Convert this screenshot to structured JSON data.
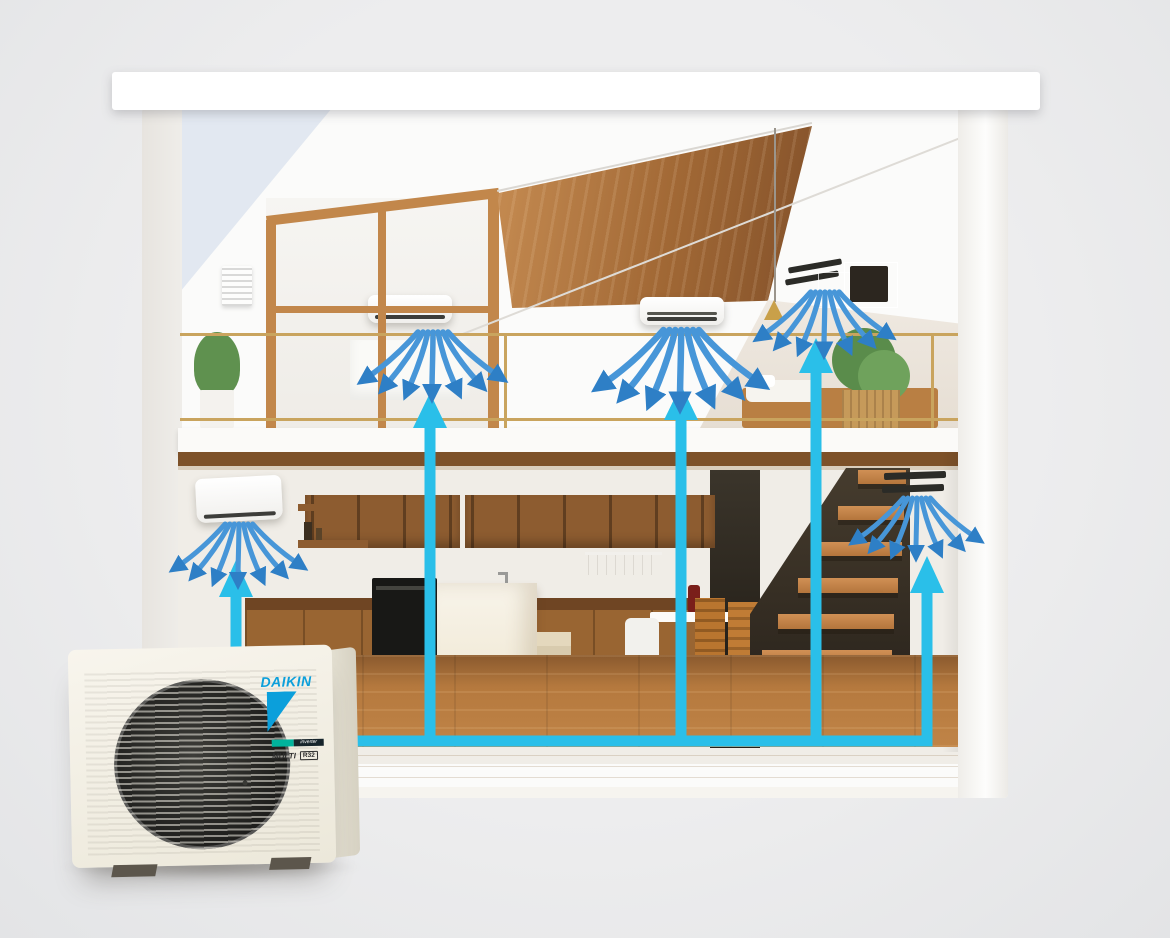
{
  "scene": {
    "description": "Cutaway illustration of a two-storey house showing a Daikin multi-split air-conditioning system: one outdoor unit connected by cyan refrigerant lines to five indoor units, each blowing cool air (blue arrows)",
    "background_color": "#e9eaeb",
    "pipe_color": "#2abfe9",
    "airflow_color": "#4796d8",
    "wood_color": "#a16835",
    "visible_text": [
      "DAIKIN",
      "inverter",
      "MULTI",
      "R32"
    ]
  },
  "outdoor_unit": {
    "brand": "DAIKIN",
    "brand_color": "#0b9fdb",
    "series_label": "inverter",
    "model_label": "MULTI",
    "refrigerant_badge": "R32",
    "location": "outside house, bottom left"
  },
  "indoor_units": [
    {
      "id": "ground-floor-left",
      "type": "wall-mounted",
      "location": "ground floor kitchen, left wall",
      "airflow": "fan of blue arrows downward"
    },
    {
      "id": "upper-floor-left",
      "type": "wall-mounted",
      "location": "upper floor left bedroom behind sliding doors",
      "airflow": "fan of blue arrows downward"
    },
    {
      "id": "upper-floor-middle",
      "type": "wall-mounted",
      "location": "upper floor living area under sloped wood ceiling",
      "airflow": "fan of blue arrows downward"
    },
    {
      "id": "upper-floor-right",
      "type": "concealed-slot",
      "location": "upper floor right wall near bed",
      "airflow": "fan of blue arrows downward"
    },
    {
      "id": "ground-floor-right",
      "type": "concealed-slot",
      "location": "ground floor wall beside staircase",
      "airflow": "fan of blue arrows downward"
    }
  ],
  "piping": {
    "style": "cyan lines with upward arrowheads",
    "main_run": "horizontal along ground floor from outdoor unit to right wall",
    "branches": 5
  }
}
